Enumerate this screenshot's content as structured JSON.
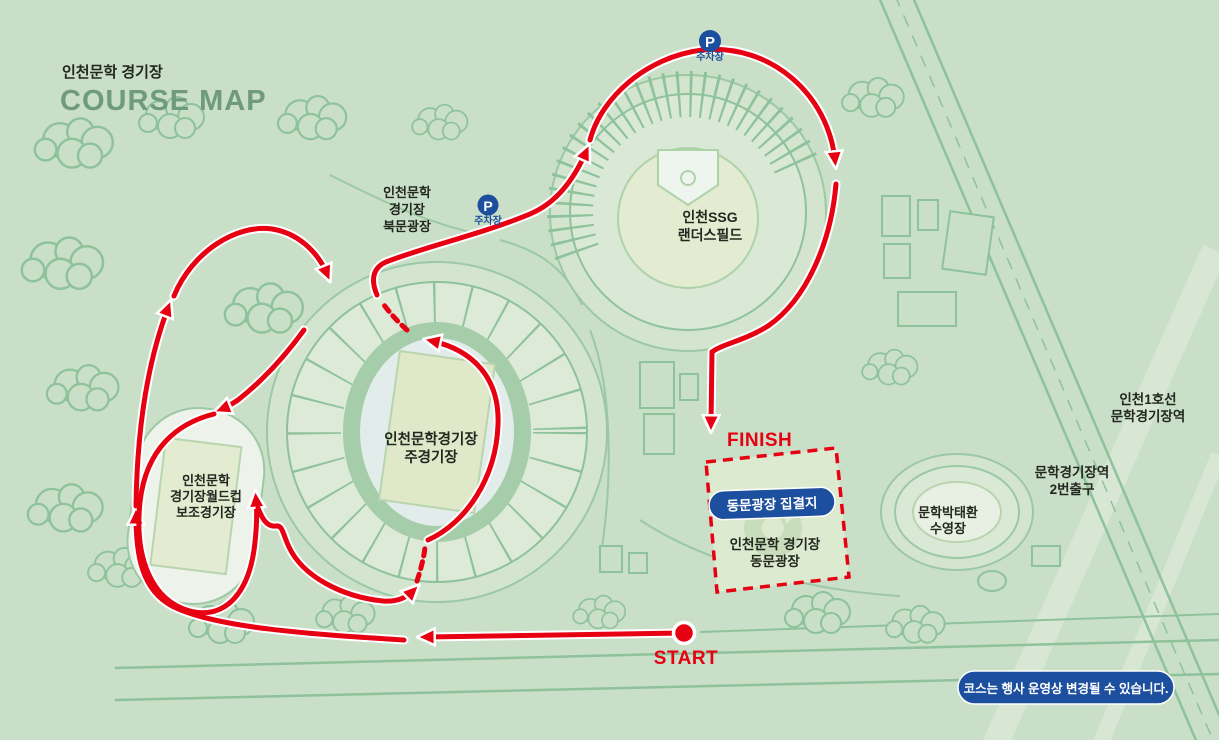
{
  "title": {
    "kr": "인천문학 경기장",
    "en": "COURSE MAP"
  },
  "course": {
    "start_label": "START",
    "finish_label": "FINISH"
  },
  "parking": {
    "icon": "P",
    "label": "주차장"
  },
  "badges": {
    "assembly": "동문광장 집결지",
    "notice": "코스는 행사 운영상 변경될 수 있습니다."
  },
  "places": {
    "north_plaza": [
      "인천문학",
      "경기장",
      "북문광장"
    ],
    "ssg_field": [
      "인천SSG",
      "랜더스필드"
    ],
    "main_stadium": [
      "인천문학경기장",
      "주경기장"
    ],
    "aux_stadium": [
      "인천문학",
      "경기장월드컵",
      "보조경기장"
    ],
    "east_plaza": [
      "인천문학 경기장",
      "동문광장"
    ],
    "pool": [
      "문학박태환",
      "수영장"
    ],
    "subway": [
      "인천1호선",
      "문학경기장역"
    ],
    "exit": [
      "문학경기장역",
      "2번출구"
    ]
  },
  "colors": {
    "background": "#c9dfc7",
    "line_green": "#8ec29b",
    "plaza_green": "#d3e5cf",
    "course_red": "#e60012",
    "brand_blue": "#1d4f9f",
    "title_green": "#6f9b7b"
  }
}
